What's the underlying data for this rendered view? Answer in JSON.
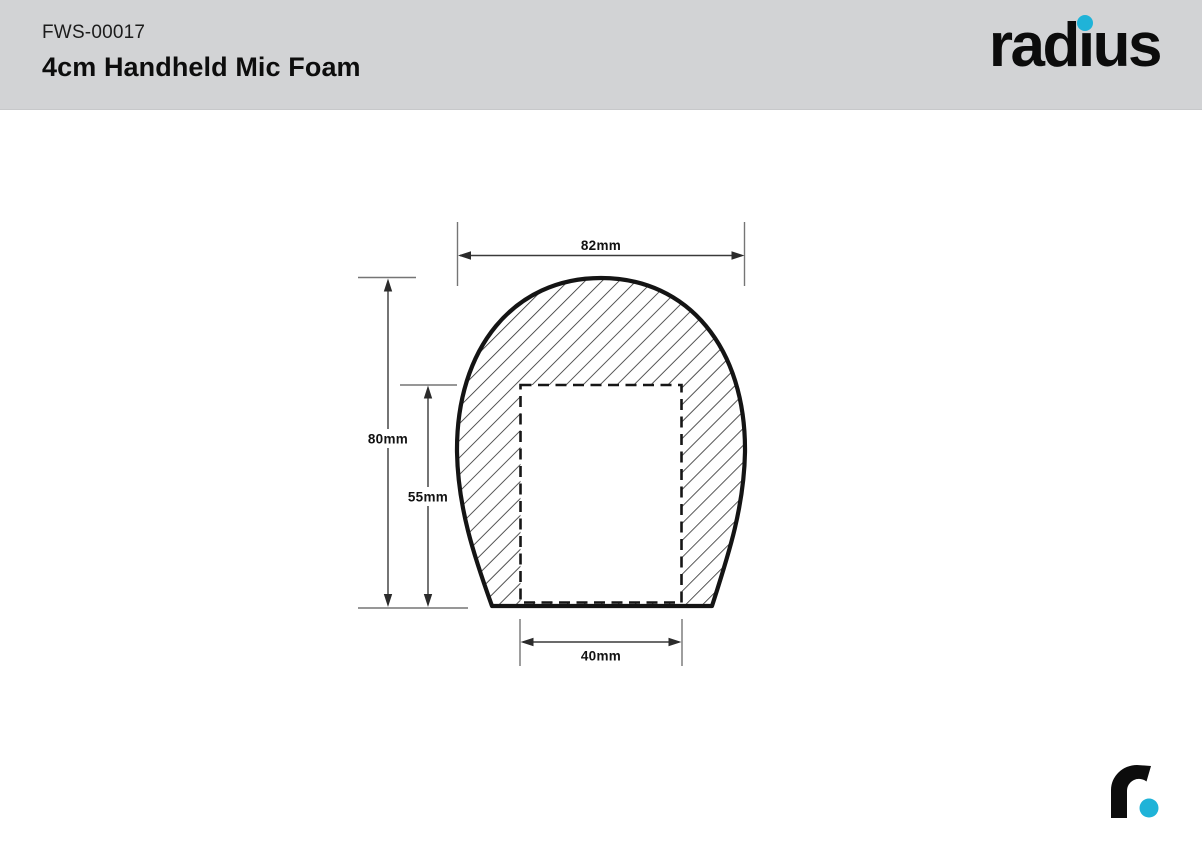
{
  "header": {
    "product_code": "FWS-00017",
    "product_name": "4cm Handheld Mic Foam"
  },
  "logo": {
    "brand": "radius",
    "part_before_i": "rad",
    "dotless_i": "ı",
    "part_after_i": "us"
  },
  "colors": {
    "accent": "#1FB3D8",
    "header_bg": "#D2D3D5",
    "outline": "#141414",
    "dimension_line": "#3A3A3A",
    "extension_line": "#757575"
  },
  "diagram": {
    "type": "dimensioned-cross-section",
    "dimensions": {
      "outer_width": "82mm",
      "outer_height": "80mm",
      "cavity_depth": "55mm",
      "cavity_width": "40mm"
    }
  }
}
